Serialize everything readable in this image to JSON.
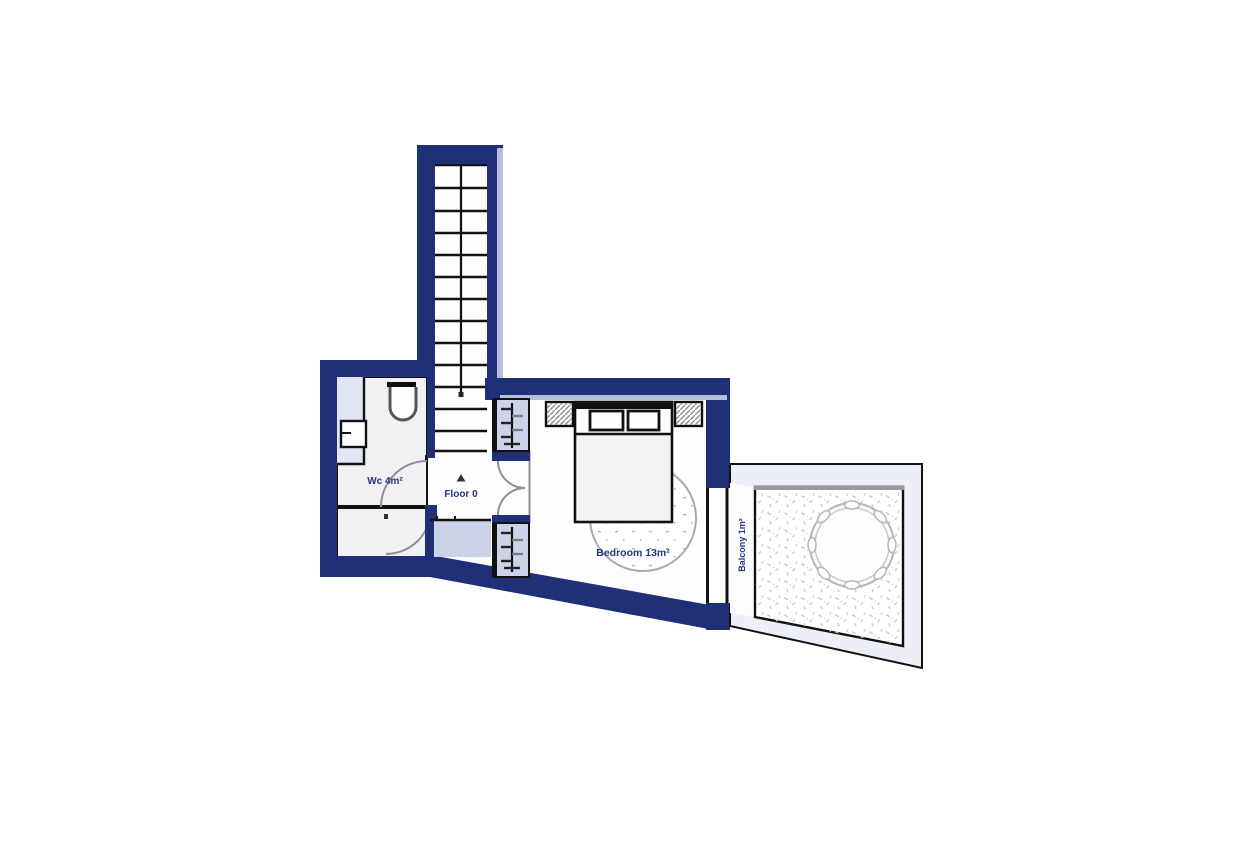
{
  "floorplan": {
    "floor_label": "Floor 0",
    "rooms": [
      {
        "name": "Wc",
        "area_m2": 4,
        "label": "Wc 4m²"
      },
      {
        "name": "Bedroom",
        "area_m2": 13,
        "label": "Bedroom 13m²"
      },
      {
        "name": "Balcony",
        "area_m2": 1,
        "label": "Balcony 1m²"
      }
    ],
    "icons": {
      "stairs": "stairs-icon",
      "walk_line": "walk-line",
      "direction_marker": "direction-arrow-icon",
      "toilet": "toilet-icon",
      "sink": "sink-icon",
      "doors": "door-arc-icon",
      "radiators": "radiator-icon",
      "bed": "bed-icon",
      "pillows": "pillow-icon",
      "nightstands": "nightstand-icon",
      "rug": "rug-icon",
      "balcony_table": "round-table-icon",
      "window": "window-icon"
    },
    "colors": {
      "wall": "#203076",
      "wall_light_edge": "#b6bede",
      "niche_fill": "#ccd2e8",
      "landing_fill": "#ccd2e8",
      "wc_floor": "#f1f1f4",
      "counter_strip": "#e2e5f3",
      "balcony_frame": "#edeff8",
      "line": "#111111",
      "door_arc": "#8e8e94",
      "label_text": "#27357e"
    }
  }
}
